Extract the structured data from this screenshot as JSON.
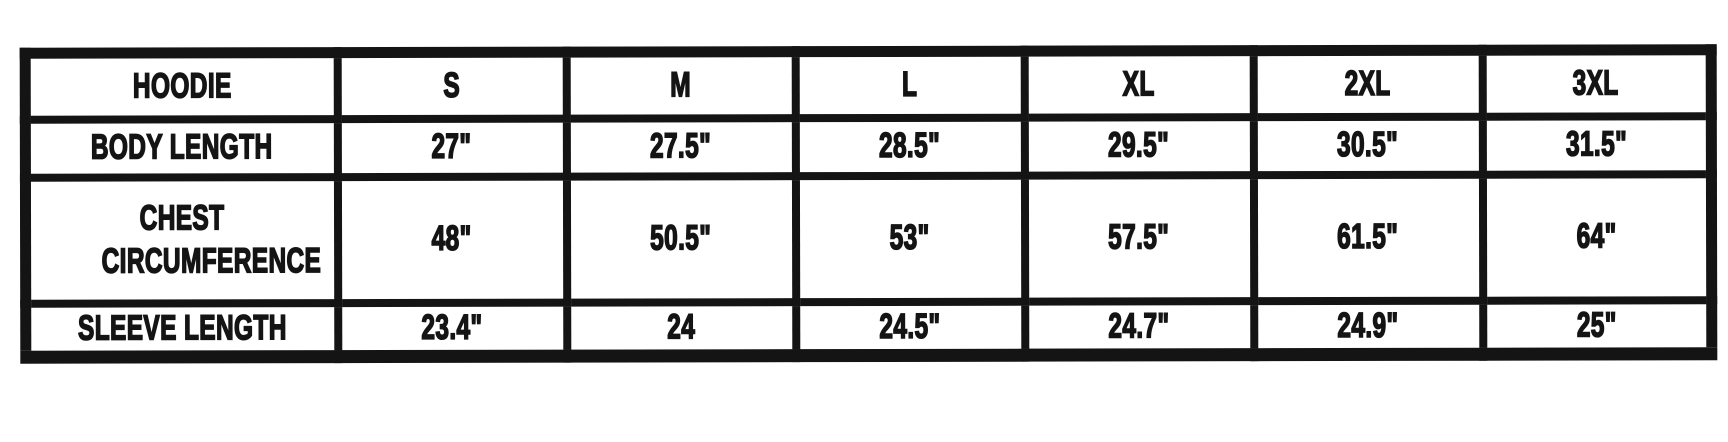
{
  "colors": {
    "ink": "#141414",
    "background": "#ffffff"
  },
  "size_chart": {
    "product": "HOODIE",
    "header": [
      "HOODIE",
      "S",
      "M",
      "L",
      "XL",
      "2XL",
      "3XL"
    ],
    "rows": [
      {
        "label": "BODY LENGTH",
        "values": [
          "27\"",
          "27.5\"",
          "28.5\"",
          "29.5\"",
          "30.5\"",
          "31.5\""
        ]
      },
      {
        "label": "CHEST CIRCUMFERENCE",
        "values": [
          "48\"",
          "50.5\"",
          "53\"",
          "57.5\"",
          "61.5\"",
          "64\""
        ]
      },
      {
        "label": "SLEEVE LENGTH",
        "values": [
          "23.4\"",
          "24",
          "24.5\"",
          "24.7\"",
          "24.9\"",
          "25\""
        ]
      }
    ]
  },
  "chart_data": {
    "type": "table",
    "columns": [
      "HOODIE",
      "S",
      "M",
      "L",
      "XL",
      "2XL",
      "3XL"
    ],
    "rows": [
      [
        "BODY LENGTH",
        "27\"",
        "27.5\"",
        "28.5\"",
        "29.5\"",
        "30.5\"",
        "31.5\""
      ],
      [
        "CHEST CIRCUMFERENCE",
        "48\"",
        "50.5\"",
        "53\"",
        "57.5\"",
        "61.5\"",
        "64\""
      ],
      [
        "SLEEVE LENGTH",
        "23.4\"",
        "24",
        "24.5\"",
        "24.7\"",
        "24.9\"",
        "25\""
      ]
    ],
    "units": "inches",
    "notes_visible_in_image": "values carry double-prime inch marks except M sleeve length (24)"
  }
}
